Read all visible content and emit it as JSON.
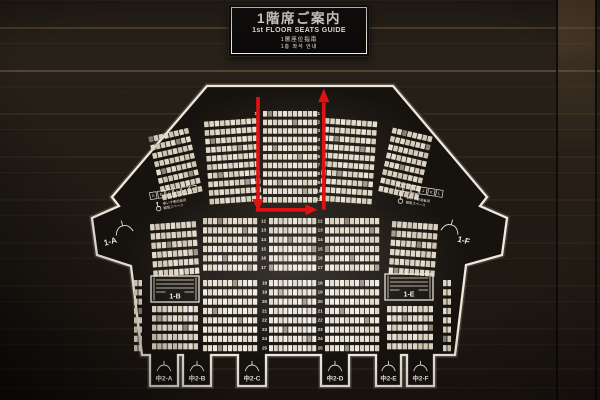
{
  "sign": {
    "title_ja": "1階席ご案内",
    "title_en": "1st FLOOR SEATS GUIDE",
    "title_zh": "1層座位指南",
    "title_ko": "1층 좌석 안내"
  },
  "map": {
    "colors": {
      "panel": "#16120e",
      "border": "#efe9dd",
      "seat": "#e8e2d3",
      "arrow": "#e01212",
      "wall": "#241d17"
    },
    "sections": {
      "side_left": "1-A",
      "side_right": "1-F",
      "box_left": "1-B",
      "box_right": "1-E",
      "entrances": [
        "中2-A",
        "中2-B",
        "中2-C",
        "中2-D",
        "中2-E",
        "中2-F"
      ]
    },
    "wheelchair": {
      "left_letters": [
        "A",
        "B",
        "C",
        "D",
        "E",
        "F"
      ],
      "right_letters": [
        "G",
        "H",
        "I",
        "J",
        "K",
        "L"
      ],
      "caption_line1": "車いす使用者用",
      "caption_line2": "観覧スペース"
    },
    "row_numbers": {
      "upper": [
        "1",
        "2",
        "3",
        "4",
        "5",
        "6",
        "7",
        "8",
        "9",
        "10",
        "11"
      ],
      "middle": [
        "12",
        "13",
        "14",
        "15",
        "16",
        "17"
      ],
      "lower": [
        "18",
        "19",
        "20",
        "21",
        "22",
        "23",
        "24",
        "25"
      ]
    },
    "number_columns": [
      {
        "rows": "upper",
        "x": 255.8,
        "y0": 113.8,
        "pitch": 8.6
      },
      {
        "rows": "upper",
        "x": 318.8,
        "y0": 113.8,
        "pitch": 8.6
      },
      {
        "rows": "middle",
        "x": 263.5,
        "y0": 221.2,
        "pitch": 9.3
      },
      {
        "rows": "middle",
        "x": 320.2,
        "y0": 221.2,
        "pitch": 9.3
      },
      {
        "rows": "lower",
        "x": 264.5,
        "y0": 283.2,
        "pitch": 9.3
      },
      {
        "rows": "lower",
        "x": 320.2,
        "y0": 283.2,
        "pitch": 9.3
      }
    ],
    "seat_blocks": [
      {
        "id": "upper-left-outer",
        "x": 148,
        "y": 127,
        "rows": 8,
        "cols": 8,
        "px": 5.2,
        "py": 8.5,
        "h": 5.6,
        "rot": -13,
        "ox": 192,
        "oy": 131
      },
      {
        "id": "upper-left-center",
        "x": 204,
        "y": 118,
        "rows": 10,
        "cols": 10,
        "px": 5.3,
        "py": 8.6,
        "h": 5.6,
        "rot": -4,
        "ox": 257,
        "oy": 121
      },
      {
        "id": "upper-center",
        "x": 263,
        "y": 111,
        "rows": 11,
        "cols": 11,
        "px": 5.0,
        "py": 8.6,
        "h": 5.6,
        "rot": 0
      },
      {
        "id": "upper-right-center",
        "x": 325,
        "y": 118,
        "rows": 10,
        "cols": 10,
        "px": 5.3,
        "py": 8.6,
        "h": 5.6,
        "rot": 4,
        "ox": 325,
        "oy": 121
      },
      {
        "id": "upper-right-outer",
        "x": 392,
        "y": 127,
        "rows": 8,
        "cols": 8,
        "px": 5.2,
        "py": 8.5,
        "h": 5.6,
        "rot": 13,
        "ox": 390,
        "oy": 131
      },
      {
        "id": "mid-left-outer",
        "x": 150,
        "y": 221,
        "rows": 6,
        "cols": 9,
        "px": 5.2,
        "py": 9.3,
        "h": 6.2,
        "rot": -4,
        "ox": 197,
        "oy": 224
      },
      {
        "id": "mid-left-center",
        "x": 203,
        "y": 218,
        "rows": 6,
        "cols": 11,
        "px": 5.0,
        "py": 9.3,
        "h": 6.2,
        "rot": 0
      },
      {
        "id": "mid-center",
        "x": 269,
        "y": 218,
        "rows": 6,
        "cols": 10,
        "px": 4.8,
        "py": 9.3,
        "h": 6.2,
        "rot": 0
      },
      {
        "id": "mid-right-center",
        "x": 325,
        "y": 218,
        "rows": 6,
        "cols": 11,
        "px": 5.0,
        "py": 9.3,
        "h": 6.2,
        "rot": 0
      },
      {
        "id": "mid-right-outer",
        "x": 392,
        "y": 221,
        "rows": 6,
        "cols": 9,
        "px": 5.2,
        "py": 9.3,
        "h": 6.2,
        "rot": 4,
        "ox": 392,
        "oy": 224
      },
      {
        "id": "lower-far-left",
        "x": 134,
        "y": 280,
        "rows": 8,
        "cols": 2,
        "px": 4.4,
        "py": 9.3,
        "w": 3.6,
        "h": 6.2,
        "rot": 0
      },
      {
        "id": "lower-left",
        "x": 152,
        "y": 306,
        "rows": 5,
        "cols": 9,
        "px": 5.2,
        "py": 9.3,
        "h": 6.2,
        "rot": 0
      },
      {
        "id": "lower-left-center",
        "x": 203,
        "y": 280,
        "rows": 8,
        "cols": 11,
        "px": 5.0,
        "py": 9.3,
        "h": 6.2,
        "rot": 0
      },
      {
        "id": "lower-center",
        "x": 269,
        "y": 280,
        "rows": 8,
        "cols": 10,
        "px": 4.8,
        "py": 9.3,
        "h": 6.2,
        "rot": 0
      },
      {
        "id": "lower-right-center",
        "x": 325,
        "y": 280,
        "rows": 8,
        "cols": 11,
        "px": 5.0,
        "py": 9.3,
        "h": 6.2,
        "rot": 0
      },
      {
        "id": "lower-right",
        "x": 387,
        "y": 306,
        "rows": 5,
        "cols": 9,
        "px": 5.2,
        "py": 9.3,
        "h": 6.2,
        "rot": 0
      },
      {
        "id": "lower-far-right",
        "x": 443,
        "y": 280,
        "rows": 8,
        "cols": 2,
        "px": 4.4,
        "py": 9.3,
        "w": 3.6,
        "h": 6.2,
        "rot": 0
      }
    ],
    "stair_boxes": [
      {
        "section": "box_left",
        "x": 151,
        "y": 276,
        "w": 48,
        "h": 26
      },
      {
        "section": "box_right",
        "x": 385,
        "y": 274,
        "w": 48,
        "h": 26
      }
    ],
    "entrance_tabs": [
      {
        "cx": 164
      },
      {
        "cx": 197
      },
      {
        "cx": 252
      },
      {
        "cx": 335
      },
      {
        "cx": 388.5
      },
      {
        "cx": 420.5
      }
    ]
  }
}
